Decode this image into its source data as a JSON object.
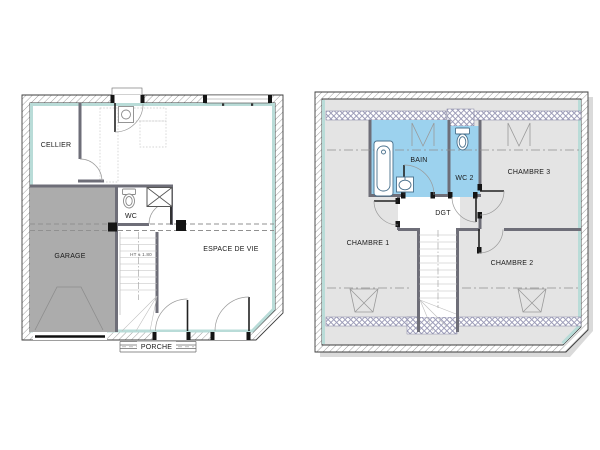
{
  "title": "Plans de la maison",
  "floors": {
    "ground": {
      "name": "Rez-de-chaussée",
      "rooms": {
        "cellier": "CELLIER",
        "garage": "GARAGE",
        "wc": "WC",
        "espace_de_vie": "ESPACE DE VIE",
        "porche": "PORCHE"
      },
      "annotations": {
        "stair_height": "HT ± 1.80"
      }
    },
    "upper": {
      "name": "Étage",
      "rooms": {
        "bain": "BAIN",
        "wc2": "WC 2",
        "chambre1": "CHAMBRE 1",
        "chambre2": "CHAMBRE 2",
        "chambre3": "CHAMBRE 3",
        "dgt": "DGT"
      }
    }
  },
  "colors": {
    "wet_room_fill": "#9cd2ee",
    "garage_fill": "#acacac",
    "upper_floor_fill": "#e4e4e4",
    "wall_liner": "#b9dcd8",
    "partition": "#6e6e78",
    "shadow": "#dadada",
    "post": "#141414"
  }
}
